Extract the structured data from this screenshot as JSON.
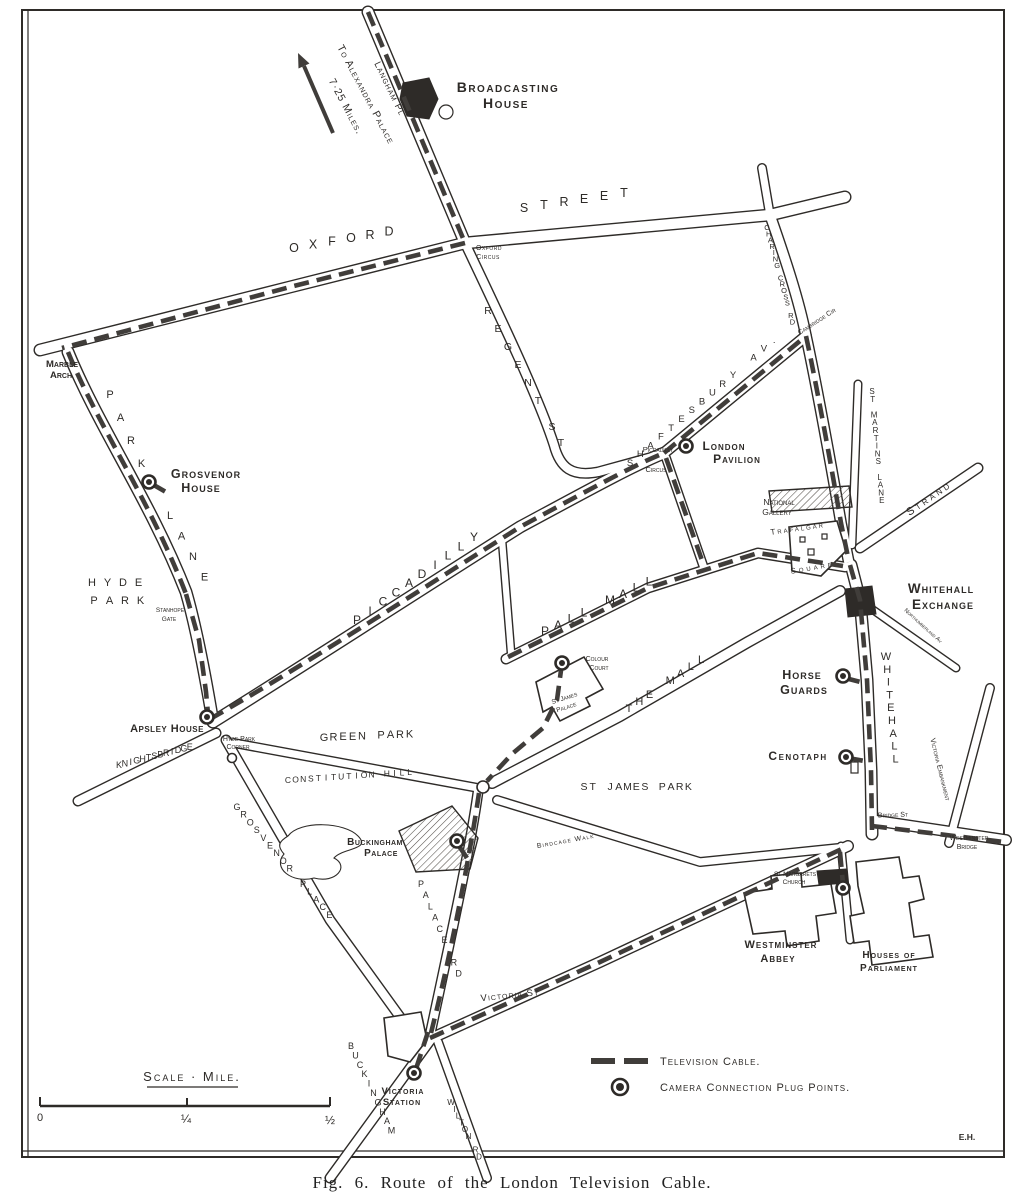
{
  "figure": {
    "caption": "Fig. 6. Route of the London Television Cable."
  },
  "legend": {
    "cable_label": "Television Cable.",
    "plug_label": "Camera Connection Plug Points."
  },
  "scale_bar": {
    "title": "Scale · Mile.",
    "tick_start": "0",
    "tick_mid": "¼",
    "tick_end": "½"
  },
  "colors": {
    "ink": "#2e2b28",
    "cable": "#403d3a",
    "paper": "#ffffff"
  },
  "map_labels": [
    {
      "name": "to-alexandra-line1",
      "text": "To Alexandra Palace",
      "x": 363,
      "y": 96,
      "size": 10.5,
      "rot": 62,
      "sp": 1
    },
    {
      "name": "to-alexandra-line2",
      "text": "7·25 Miles.",
      "x": 343,
      "y": 108,
      "size": 10.5,
      "rot": 62,
      "sp": 1
    },
    {
      "name": "langham-pl",
      "text": "Langham Pl",
      "x": 387,
      "y": 90,
      "size": 9.5,
      "rot": 64,
      "sp": 1
    },
    {
      "name": "broadcasting-house-1",
      "text": "Broadcasting",
      "x": 508,
      "y": 92,
      "size": 14,
      "sp": 1.5,
      "bold": true
    },
    {
      "name": "broadcasting-house-2",
      "text": "House",
      "x": 506,
      "y": 108,
      "size": 14,
      "sp": 1.5,
      "bold": true
    },
    {
      "name": "oxford-street-oxford",
      "text": "OXFORD",
      "x": 294,
      "y": 252,
      "size": 12.5,
      "dx": 19,
      "dy": -3.3
    },
    {
      "name": "oxford-street-street",
      "text": "STREET",
      "x": 524,
      "y": 212,
      "size": 12.5,
      "dx": 20,
      "dy": -3
    },
    {
      "name": "oxford-circus-1",
      "text": "Oxford",
      "x": 489,
      "y": 250,
      "size": 7,
      "sp": 0.5
    },
    {
      "name": "oxford-circus-2",
      "text": "Circus",
      "x": 488,
      "y": 259,
      "size": 7,
      "sp": 0.5
    },
    {
      "name": "marble-arch-1",
      "text": "Marble",
      "x": 62,
      "y": 367,
      "size": 9.5,
      "bold": true
    },
    {
      "name": "marble-arch-2",
      "text": "Arch",
      "x": 61,
      "y": 378,
      "size": 9.5,
      "bold": true
    },
    {
      "name": "park-lane-park",
      "text": "PARK",
      "x": 110,
      "y": 398,
      "size": 11,
      "dx": 10.5,
      "dy": 23
    },
    {
      "name": "park-lane-lane",
      "text": "LANE",
      "x": 170,
      "y": 519,
      "size": 11,
      "dx": 11.5,
      "dy": 20.5
    },
    {
      "name": "grosvenor-house-1",
      "text": "Grosvenor",
      "x": 206,
      "y": 478,
      "size": 12.5,
      "sp": 1,
      "bold": true
    },
    {
      "name": "grosvenor-house-2",
      "text": "House",
      "x": 201,
      "y": 492,
      "size": 12.5,
      "sp": 1,
      "bold": true
    },
    {
      "name": "hyde-park-hyde",
      "text": "HYDE",
      "x": 92,
      "y": 586,
      "size": 11,
      "dx": 15.5,
      "dy": 0
    },
    {
      "name": "hyde-park-park",
      "text": "PARK",
      "x": 94,
      "y": 604,
      "size": 11,
      "dx": 15.5,
      "dy": 0
    },
    {
      "name": "stanhope-gate-1",
      "text": "Stanhope",
      "x": 170,
      "y": 612,
      "size": 6.5
    },
    {
      "name": "stanhope-gate-2",
      "text": "Gate",
      "x": 169,
      "y": 621,
      "size": 6.5
    },
    {
      "name": "apsley-house",
      "text": "Apsley House",
      "x": 167,
      "y": 732,
      "size": 11,
      "sp": 0.5,
      "bold": true
    },
    {
      "name": "hyde-park-corner-1",
      "text": "Hyde Park",
      "x": 239,
      "y": 741,
      "size": 7
    },
    {
      "name": "hyde-park-corner-2",
      "text": "Corner",
      "x": 238,
      "y": 749,
      "size": 7
    },
    {
      "name": "knightsbridge",
      "text": "KNIGHTSBRIDGE",
      "x": 119,
      "y": 768,
      "size": 9,
      "dx": 5.9,
      "dy": -1.5
    },
    {
      "name": "regent-st-regent",
      "text": "REGENT",
      "x": 488,
      "y": 314,
      "size": 10.5,
      "dx": 10,
      "dy": 18
    },
    {
      "name": "regent-st-st",
      "text": "ST",
      "x": 552,
      "y": 430,
      "size": 10.5,
      "dx": 9,
      "dy": 16
    },
    {
      "name": "piccadilly-street",
      "text": "PICCADILLY",
      "x": 357,
      "y": 624,
      "size": 12,
      "dx": 13,
      "dy": -9.2
    },
    {
      "name": "shaftesbury-av",
      "text": "SHAFTESBURY AV.",
      "x": 630,
      "y": 466,
      "size": 9.5,
      "dx": 10.3,
      "dy": -8.8
    },
    {
      "name": "piccadilly-circus-1",
      "text": "Piccadilly",
      "x": 658,
      "y": 452,
      "size": 7.5
    },
    {
      "name": "piccadilly-circus-2",
      "text": "Circus",
      "x": 656,
      "y": 472,
      "size": 7.5
    },
    {
      "name": "london-pavilion-1",
      "text": "London",
      "x": 724,
      "y": 450,
      "size": 12,
      "sp": 1,
      "bold": true
    },
    {
      "name": "london-pavilion-2",
      "text": "Pavilion",
      "x": 737,
      "y": 463,
      "size": 12,
      "sp": 1,
      "bold": true
    },
    {
      "name": "charing-cross-rd",
      "text": "CHARING CROSS RD",
      "x": 767,
      "y": 230,
      "size": 7.5,
      "dx": 1.7,
      "dy": 6.3
    },
    {
      "name": "cambridge-circus",
      "text": "Cambridge Cir",
      "x": 818,
      "y": 323,
      "size": 7,
      "rot": -33
    },
    {
      "name": "st-martins-lane",
      "text": "ST MARTINS LANE",
      "x": 872,
      "y": 394,
      "size": 8,
      "dx": 0.7,
      "dy": 7.8
    },
    {
      "name": "strand",
      "text": "Strand",
      "x": 931,
      "y": 501,
      "size": 11,
      "rot": -35,
      "sp": 3
    },
    {
      "name": "national-gallery-1",
      "text": "National",
      "x": 779,
      "y": 505,
      "size": 8.5
    },
    {
      "name": "national-gallery-2",
      "text": "Gallery",
      "x": 777,
      "y": 515,
      "size": 8.5
    },
    {
      "name": "trafalgar",
      "text": "Trafalgar",
      "x": 798,
      "y": 531,
      "size": 8,
      "rot": -8,
      "sp": 2
    },
    {
      "name": "trafalgar-square",
      "text": "Square",
      "x": 813,
      "y": 570,
      "size": 8,
      "rot": -10,
      "sp": 3
    },
    {
      "name": "whitehall-exchange-1",
      "text": "Whitehall",
      "x": 941,
      "y": 593,
      "size": 13.5,
      "sp": 1,
      "bold": true
    },
    {
      "name": "whitehall-exchange-2",
      "text": "Exchange",
      "x": 943,
      "y": 609,
      "size": 13.5,
      "sp": 1,
      "bold": true
    },
    {
      "name": "northumberland-av",
      "text": "Northumberland Av",
      "x": 922,
      "y": 627,
      "size": 6,
      "rot": 42
    },
    {
      "name": "pall-mall",
      "text": "PALL MALL",
      "x": 545,
      "y": 635,
      "size": 12,
      "dx": 13,
      "dy": -6.2
    },
    {
      "name": "colour-court-1",
      "text": "Colour",
      "x": 597,
      "y": 661,
      "size": 7
    },
    {
      "name": "colour-court-2",
      "text": "Court",
      "x": 599,
      "y": 670,
      "size": 7
    },
    {
      "name": "st-james-palace-1",
      "text": "St James",
      "x": 565,
      "y": 700,
      "size": 6.5,
      "rot": -18
    },
    {
      "name": "st-james-palace-2",
      "text": "Palace",
      "x": 567,
      "y": 709,
      "size": 6.5,
      "rot": -18
    },
    {
      "name": "the-mall",
      "text": "THE MALL",
      "x": 629,
      "y": 712,
      "size": 11,
      "dx": 10.3,
      "dy": -7
    },
    {
      "name": "horse-guards-1",
      "text": "Horse",
      "x": 802,
      "y": 679,
      "size": 12.5,
      "sp": 1,
      "bold": true
    },
    {
      "name": "horse-guards-2",
      "text": "Guards",
      "x": 804,
      "y": 694,
      "size": 12.5,
      "sp": 1,
      "bold": true
    },
    {
      "name": "whitehall-street",
      "text": "WHITEHALL",
      "x": 886,
      "y": 660,
      "size": 11,
      "dx": 1.2,
      "dy": 12.8
    },
    {
      "name": "cenotaph",
      "text": "Cenotaph",
      "x": 798,
      "y": 760,
      "size": 12,
      "sp": 1.5,
      "bold": true
    },
    {
      "name": "victoria-embankment",
      "text": "Victoria Embankment",
      "x": 938,
      "y": 770,
      "size": 7.5,
      "rot": 76
    },
    {
      "name": "bridge-st",
      "text": "Bridge St",
      "x": 893,
      "y": 817,
      "size": 7,
      "rot": -2
    },
    {
      "name": "westminster-bridge-1",
      "text": "Westminster",
      "x": 969,
      "y": 840,
      "size": 7
    },
    {
      "name": "westminster-bridge-2",
      "text": "Bridge",
      "x": 967,
      "y": 849,
      "size": 7
    },
    {
      "name": "green-park",
      "text": "GREEN PARK",
      "x": 324,
      "y": 741,
      "size": 11,
      "dx": 9.5,
      "dy": -0.4
    },
    {
      "name": "constitution-hill",
      "text": "CONSTITUTION HILL",
      "x": 288,
      "y": 783,
      "size": 8.5,
      "dx": 7.6,
      "dy": -0.5
    },
    {
      "name": "st-james-park",
      "text": "ST JAMES PARK",
      "x": 584,
      "y": 790,
      "size": 10.5,
      "dx": 8.7,
      "dy": 0
    },
    {
      "name": "birdcage-walk",
      "text": "Birdcage Walk",
      "x": 566,
      "y": 843,
      "size": 7,
      "rot": -10,
      "sp": 1
    },
    {
      "name": "buckingham-palace-1",
      "text": "Buckingham",
      "x": 375,
      "y": 845,
      "size": 10,
      "sp": 0.5,
      "bold": true
    },
    {
      "name": "buckingham-palace-2",
      "text": "Palace",
      "x": 381,
      "y": 856,
      "size": 10,
      "sp": 0.5,
      "bold": true
    },
    {
      "name": "grosvenor-place",
      "text": "GROSVENOR PLACE",
      "x": 237,
      "y": 810,
      "size": 9,
      "dx": 6.6,
      "dy": 7.7
    },
    {
      "name": "palace-rd",
      "text": "PALACE RD",
      "x": 421,
      "y": 887,
      "size": 9,
      "dx": 4.7,
      "dy": 11.2
    },
    {
      "name": "victoria-st",
      "text": "Victoria St.",
      "x": 512,
      "y": 998,
      "size": 9.5,
      "rot": -6,
      "sp": 1
    },
    {
      "name": "buckingham-palace-rd",
      "text": "BUCKINGHAM",
      "x": 351,
      "y": 1049,
      "size": 9,
      "dx": 4.5,
      "dy": 9.4
    },
    {
      "name": "victoria-station-1",
      "text": "Victoria",
      "x": 403,
      "y": 1094,
      "size": 9.5,
      "sp": 1,
      "bold": true
    },
    {
      "name": "victoria-station-2",
      "text": "Station",
      "x": 402,
      "y": 1105,
      "size": 9.5,
      "sp": 1,
      "bold": true
    },
    {
      "name": "wilton-rd",
      "text": "WILTON RD",
      "x": 451,
      "y": 1105,
      "size": 8,
      "dx": 3.5,
      "dy": 6.8
    },
    {
      "name": "st-margarets-1",
      "text": "St Margarets",
      "x": 795,
      "y": 876,
      "size": 6.5
    },
    {
      "name": "st-margarets-2",
      "text": "Church",
      "x": 794,
      "y": 884,
      "size": 6.5
    },
    {
      "name": "westminster-abbey-1",
      "text": "Westminster",
      "x": 781,
      "y": 948,
      "size": 11,
      "sp": 1,
      "bold": true
    },
    {
      "name": "westminster-abbey-2",
      "text": "Abbey",
      "x": 778,
      "y": 962,
      "size": 11,
      "sp": 1,
      "bold": true
    },
    {
      "name": "houses-parliament-1",
      "text": "Houses of",
      "x": 889,
      "y": 958,
      "size": 10,
      "sp": 1,
      "bold": true
    },
    {
      "name": "houses-parliament-2",
      "text": "Parliament",
      "x": 889,
      "y": 971,
      "size": 10,
      "sp": 1,
      "bold": true
    },
    {
      "name": "artist-initials",
      "text": "E.H.",
      "x": 967,
      "y": 1140,
      "size": 8.5,
      "bold": true
    }
  ],
  "plug_points": [
    {
      "name": "grosvenor-house-plug",
      "x": 149,
      "y": 482
    },
    {
      "name": "apsley-house-plug",
      "x": 207,
      "y": 717
    },
    {
      "name": "london-pavilion-plug",
      "x": 686,
      "y": 446
    },
    {
      "name": "colour-court-plug",
      "x": 562,
      "y": 663
    },
    {
      "name": "buckingham-palace-plug",
      "x": 457,
      "y": 841
    },
    {
      "name": "horse-guards-plug",
      "x": 843,
      "y": 676
    },
    {
      "name": "cenotaph-plug",
      "x": 846,
      "y": 757
    },
    {
      "name": "victoria-station-plug",
      "x": 414,
      "y": 1073
    },
    {
      "name": "st-margarets-plug",
      "x": 843,
      "y": 888
    }
  ]
}
